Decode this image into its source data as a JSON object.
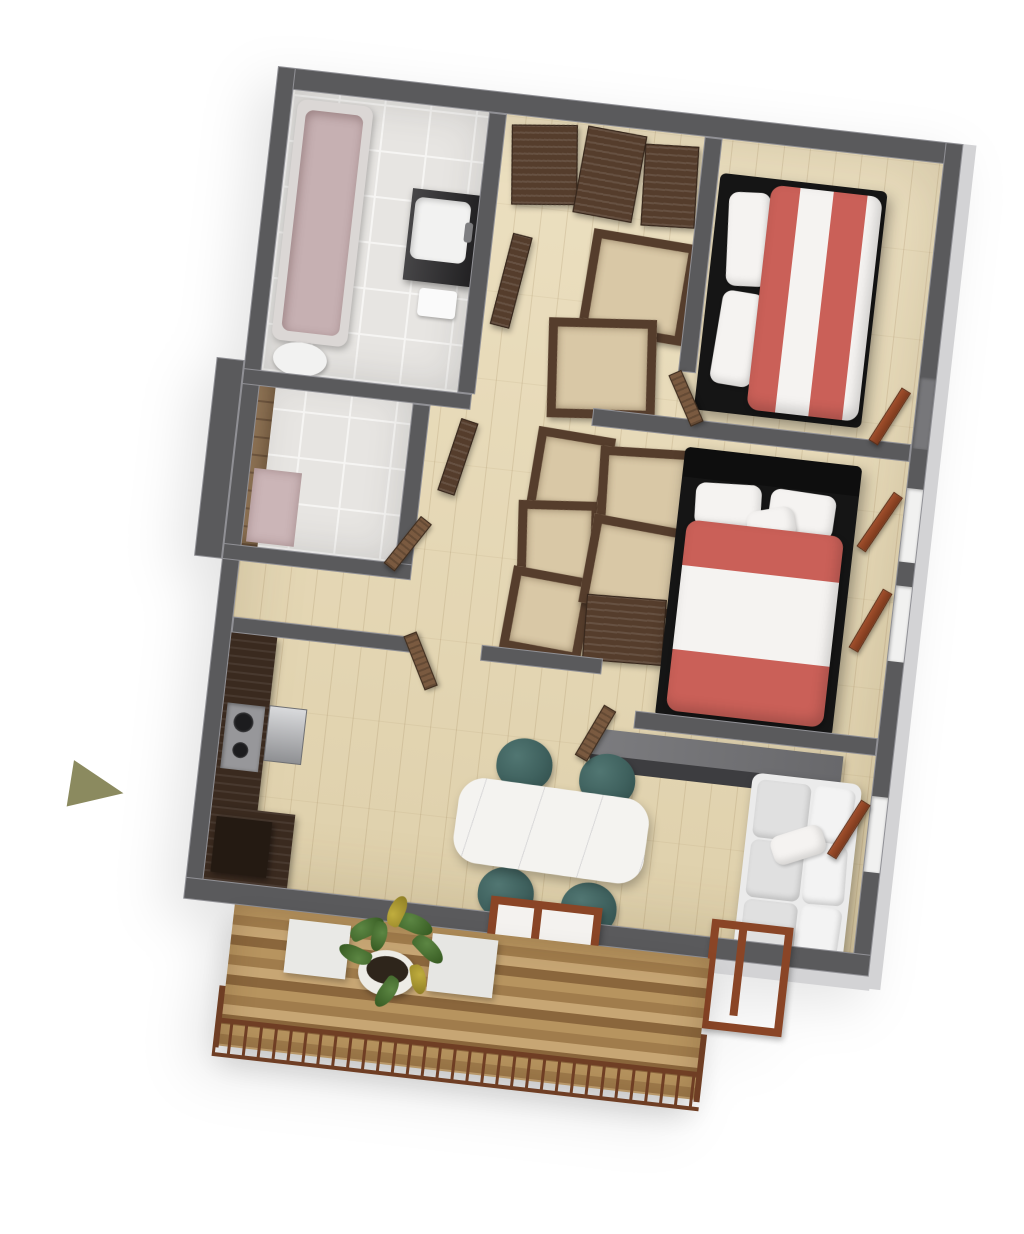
{
  "scene": {
    "type": "3d-floor-plan-render",
    "view": "isometric top-down, slightly rotated clockwise",
    "visible_text": "none",
    "orientation_marker": "olive right-pointing triangle at left edge",
    "rooms": [
      {
        "name": "bathroom-top",
        "floor": "light-tile",
        "furniture": [
          "bathtub",
          "washbasin-vanity",
          "toilet"
        ]
      },
      {
        "name": "entry-hall-closet",
        "floor": "wood",
        "furniture": [
          "open-wardrobe-panels",
          "open-wardrobe-boxes"
        ]
      },
      {
        "name": "bedroom-1",
        "floor": "wood",
        "furniture": [
          "double-bed-red-white-striped-duvet",
          "white-pillows"
        ]
      },
      {
        "name": "bathroom-2",
        "floor": "light-tile",
        "furniture": [
          "stone-accent-wall",
          "washbasin-vanity",
          "shower-mat",
          "open-wood-door"
        ]
      },
      {
        "name": "closet-corridor",
        "floor": "wood",
        "furniture": [
          "open-wardrobe-units"
        ]
      },
      {
        "name": "bedroom-2",
        "floor": "wood",
        "furniture": [
          "double-bed-red-white-striped-duvet",
          "wardrobe-units",
          "open-casement-windows"
        ]
      },
      {
        "name": "kitchen",
        "floor": "wood",
        "furniture": [
          "dark-wood-counter",
          "cooktop",
          "steel-oven",
          "tall-unit"
        ]
      },
      {
        "name": "living-dining",
        "floor": "wood",
        "furniture": [
          "white-marble-dining-table",
          "teal-tub-chairs",
          "white-three-seat-sofa",
          "gray-media-sideboard",
          "window-frame",
          "balcony-door-frame"
        ]
      },
      {
        "name": "balcony",
        "floor": "wood-plank-deck",
        "furniture": [
          "metal-railing",
          "potted-plant",
          "white-planter-boxes"
        ]
      }
    ],
    "counts": {
      "beds": 2,
      "teal_chairs": 4,
      "bathrooms": 2,
      "casement_windows": 4
    }
  },
  "palette": {
    "wallTop": "#5a5a5c",
    "wallOuter": "#d3d3d5",
    "woodFloor": "#e8d9b3",
    "tile": "#e7e5e2",
    "grout": "#f6f5f3",
    "stone": "#8d7254",
    "stoneLine": "#6f5740",
    "tubRim": "#dbd7d5",
    "tubFill": "#c6b0b2",
    "fixtureWhite": "#f2f2f1",
    "counter": "#2d2c2e",
    "brown": "#553d2c",
    "brownLight": "#7a5a40",
    "boxInner": "#d9c8a6",
    "bedFrame": "#151515",
    "bedRed": "#ca6058",
    "bedWhite": "#f5f3f1",
    "teal": "#3f615e",
    "tealDark": "#2f4b49",
    "marble": "#f4f3f0",
    "sofa": "#ebebeb",
    "sofaCushion": "#e0e0e0",
    "cabTop": "#7c7c7f",
    "cabFront": "#3d3d40",
    "steelA": "#d9dadc",
    "steelB": "#8f9093",
    "deckA": "#b7945f",
    "deckB": "#a07c4c",
    "deckC": "#c7a674",
    "deckD": "#8a663c",
    "rail": "#6f3e24",
    "plantG": "#5c8643",
    "plantD": "#33571f",
    "plantY": "#c0ad3e",
    "pot": "#edece6",
    "soil": "#2e251b",
    "arrow": "#8b8a5f"
  }
}
